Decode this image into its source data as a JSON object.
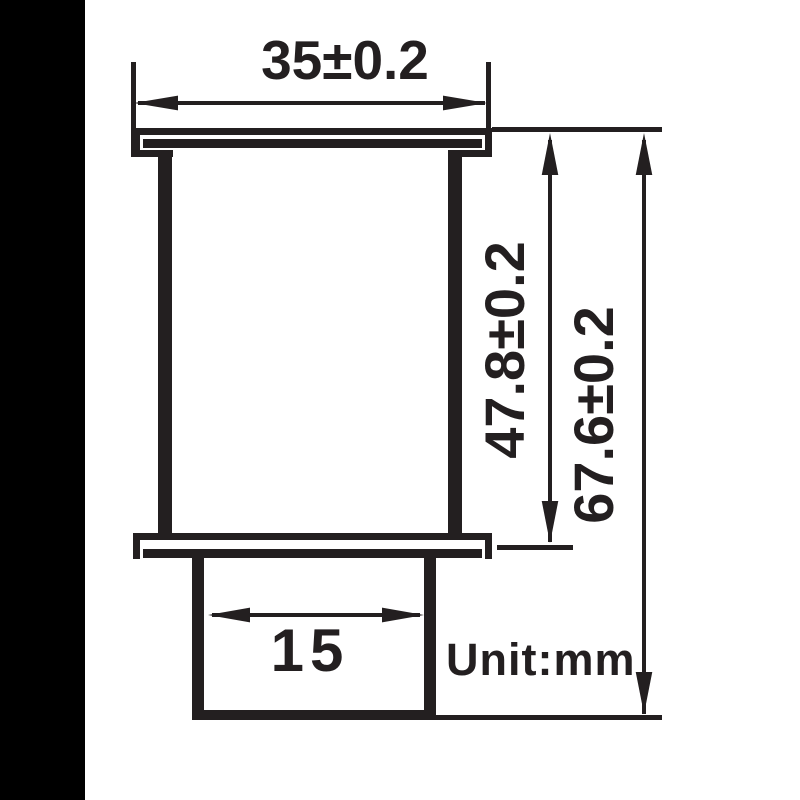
{
  "diagram": {
    "unit_label": "Unit:mm",
    "dims": {
      "top_width": "35±0.2",
      "inner_height": "47.8±0.2",
      "overall_height": "67.6±0.2",
      "stem_width": "15"
    },
    "dimension_values": {
      "top_width_mm": 35,
      "top_width_tolerance_mm": 0.2,
      "inner_height_mm": 47.8,
      "inner_height_tolerance_mm": 0.2,
      "overall_height_mm": 67.6,
      "overall_height_tolerance_mm": 0.2,
      "stem_width_mm": 15
    },
    "colors": {
      "ink": "#231f20",
      "paper": "#ffffff",
      "panel": "#000000"
    }
  }
}
